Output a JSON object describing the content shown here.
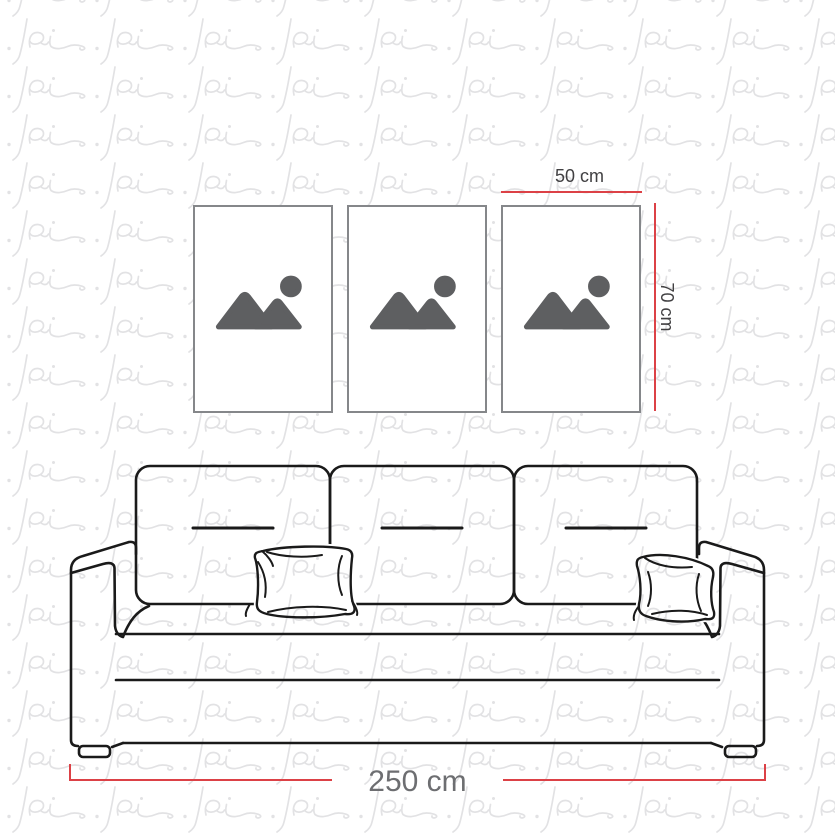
{
  "watermark": {
    "motif_text": "pi",
    "color": "#e2e2e4"
  },
  "gallery": {
    "frame_count": 3,
    "frame_border_color": "#85878a",
    "frames": [
      {
        "icon": "image-placeholder-icon"
      },
      {
        "icon": "image-placeholder-icon"
      },
      {
        "icon": "image-placeholder-icon"
      }
    ],
    "icon_color": "#5e5f61"
  },
  "dimensions": {
    "accent_color": "#dc4146",
    "small_label_color": "#414042",
    "large_label_color": "#6d6e71",
    "frame_width": {
      "label": "50 cm"
    },
    "frame_height": {
      "label": "70 cm"
    },
    "sofa_width": {
      "label": "250 cm"
    }
  },
  "sofa": {
    "description": "three-seat sofa line drawing",
    "stroke_color": "#1a1a1a",
    "back_cushions": 3,
    "pillows": 2
  }
}
